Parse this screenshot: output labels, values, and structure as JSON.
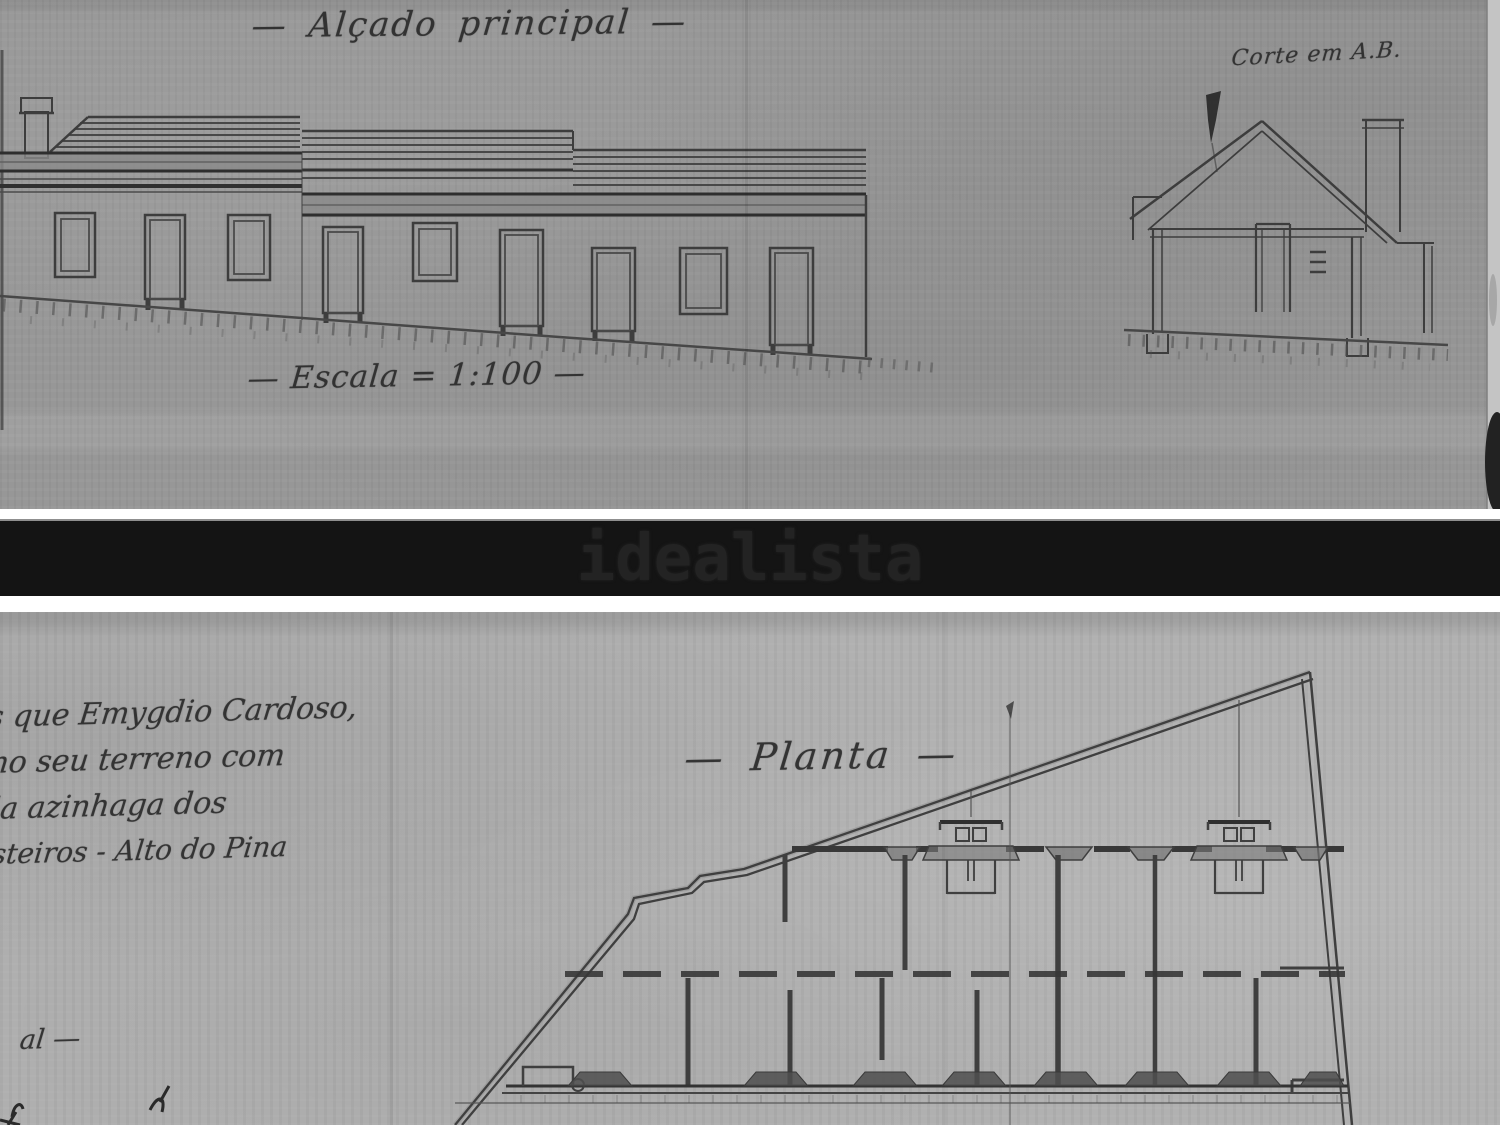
{
  "brand_band": {
    "label": "idealista",
    "band_color": "#141414",
    "text_color": "#232323"
  },
  "elevation_sheet": {
    "title": "— Alçado principal —",
    "scale_note": "— Escala = 1:100 —",
    "section_note": "Corte em A.B."
  },
  "plan_sheet": {
    "title": "— Planta —",
    "margin_note_lines": [
      "s que Emygdio Cardoso,",
      "no seu terreno com",
      "la azinhaga dos",
      "steiros - Alto do Pina"
    ],
    "margin_fragment": "al —"
  },
  "colors": {
    "paper_top": "#979797",
    "paper_bottom": "#b1b1b1",
    "ink": "#3a3a3a"
  }
}
